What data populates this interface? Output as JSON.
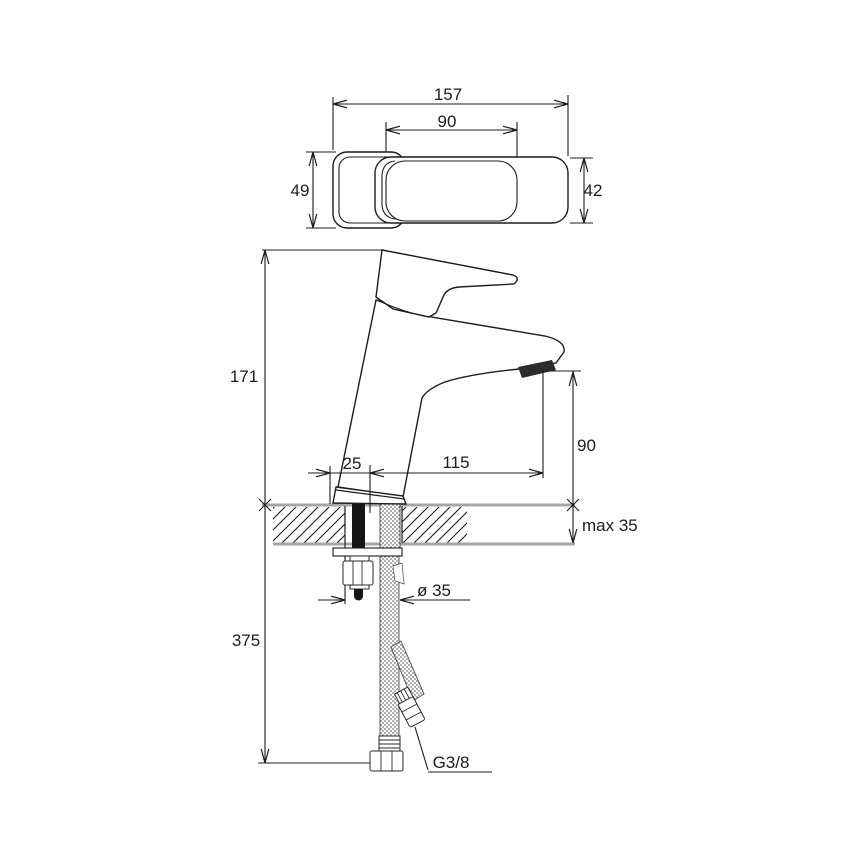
{
  "drawing": {
    "kind": "technical-dimension-drawing",
    "subject": "single-lever basin faucet, top view and front view with flexible supply hoses",
    "line_color": "#1c1c1c",
    "counter_color": "#a6a6a6",
    "top_view": {
      "total_length": "157",
      "lever_length": "90",
      "body_width": "49",
      "lever_width": "42"
    },
    "front_view": {
      "height": "171",
      "base_offset": "25",
      "spout_reach": "115",
      "spout_height": "90",
      "deck_thickness": "max 35",
      "hose_length": "375",
      "hole_diameter": "ø 35",
      "thread_size": "G3/8"
    }
  }
}
